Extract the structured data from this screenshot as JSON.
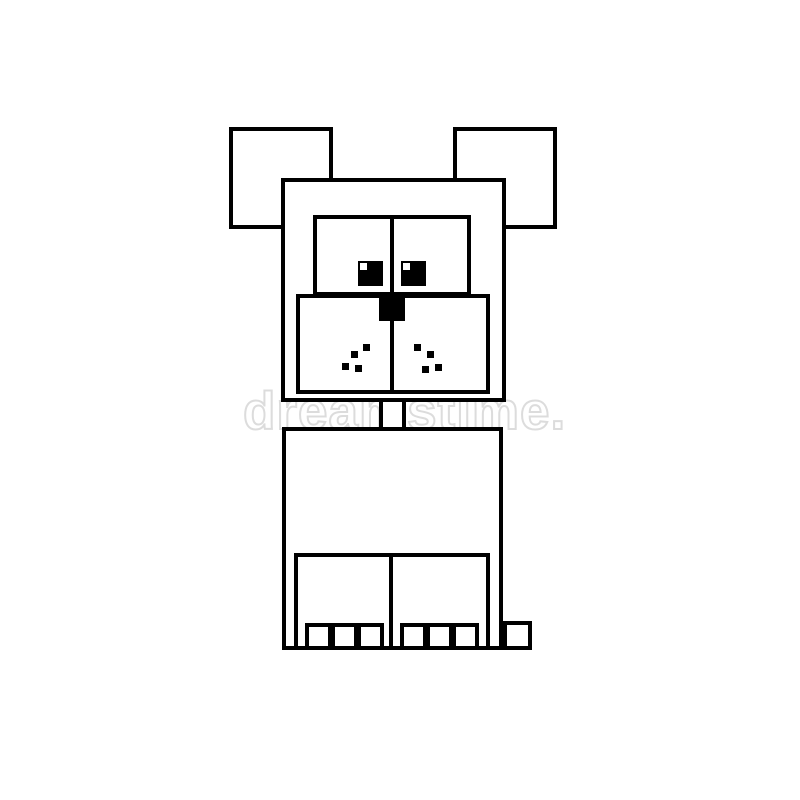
{
  "image": {
    "description": "Black and white geometric pixel-style illustration of a sitting dog, built from outlined squares and rectangles on a white background",
    "style": "line-art clip art, square/blocky shapes, black outlines on white"
  },
  "colors": {
    "line": "#000000",
    "fill": "#ffffff",
    "bg": "#ffffff",
    "wm": "#dcdcdc"
  },
  "watermark": {
    "text": "dreamstime.",
    "registered": "®"
  },
  "dog": {
    "parts": [
      "left-ear",
      "right-ear",
      "head",
      "eye-panel",
      "left-eye",
      "right-eye",
      "eye-highlights",
      "muzzle",
      "nose",
      "whisker-dots",
      "neck",
      "body",
      "left-leg",
      "right-leg",
      "toes",
      "hind-paw"
    ],
    "whisker_dot_count": 8,
    "toe_count": 6
  }
}
